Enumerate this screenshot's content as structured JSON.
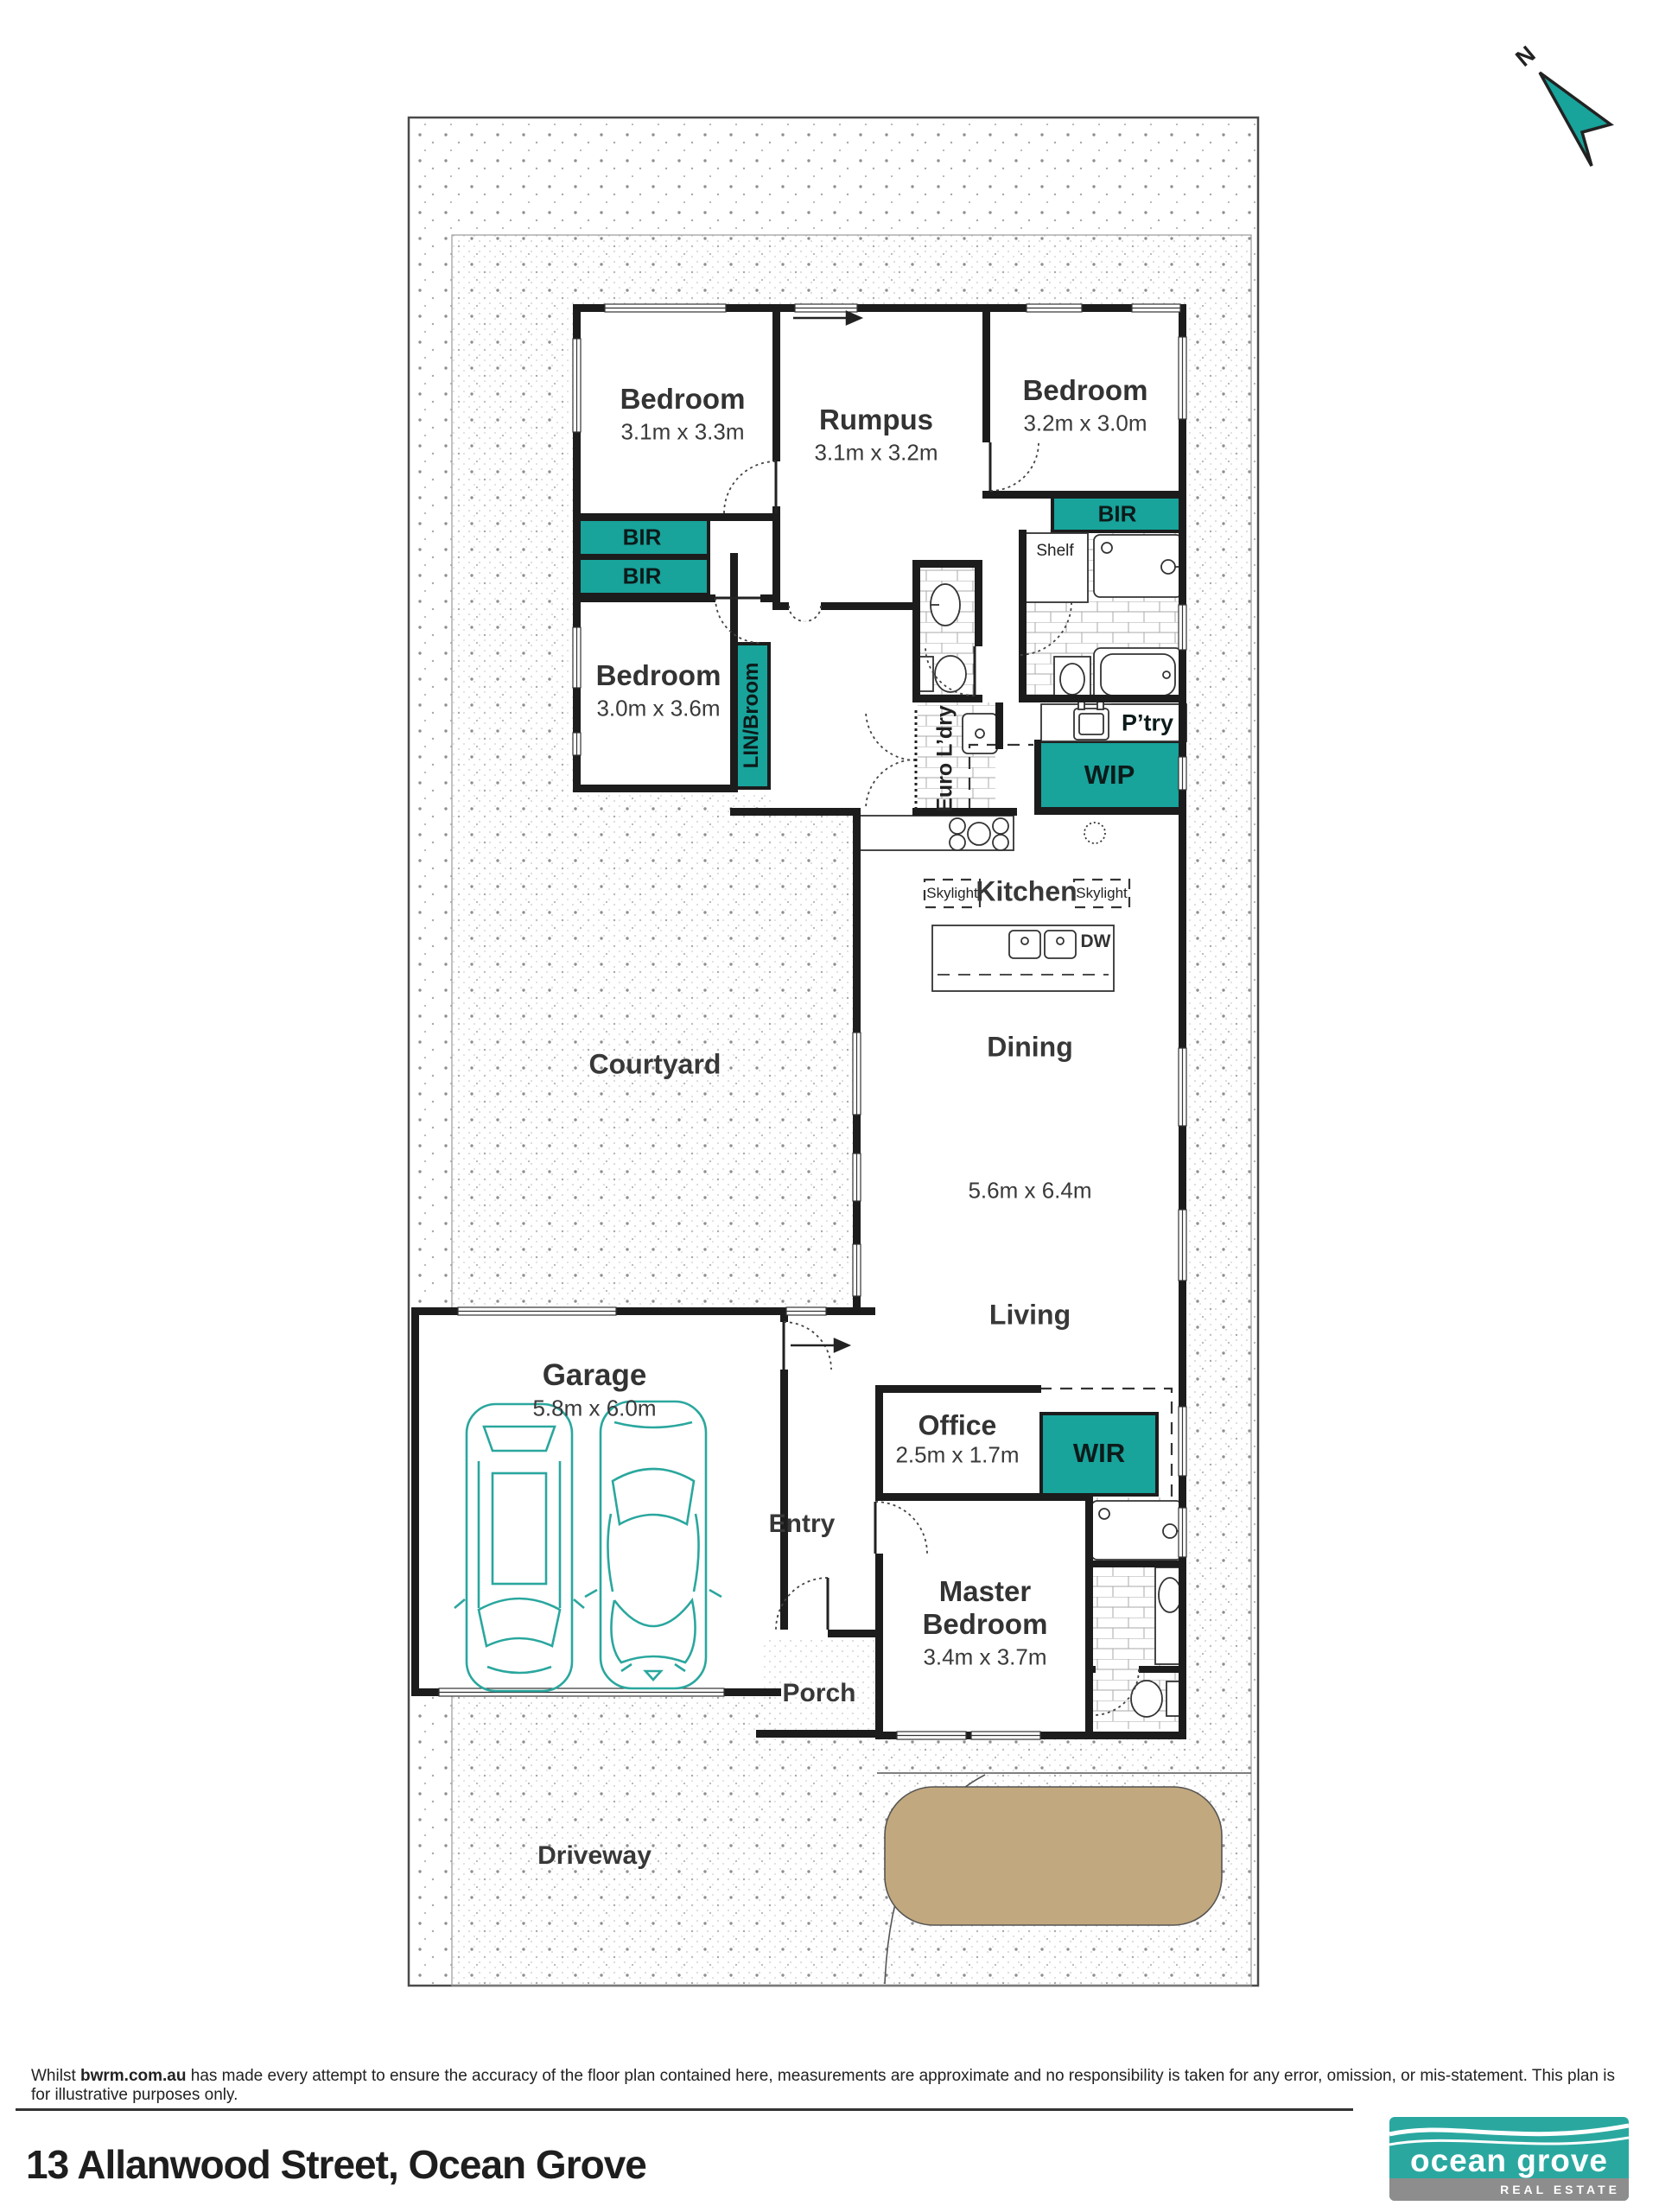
{
  "compass": {
    "north_label": "N"
  },
  "rooms": {
    "bedroom1": {
      "label": "Bedroom",
      "dims": "3.1m x 3.3m"
    },
    "rumpus": {
      "label": "Rumpus",
      "dims": "3.1m x 3.2m"
    },
    "bedroom2": {
      "label": "Bedroom",
      "dims": "3.2m x 3.0m"
    },
    "bedroom3": {
      "label": "Bedroom",
      "dims": "3.0m x 3.6m"
    },
    "courtyard": {
      "label": "Courtyard"
    },
    "dining": {
      "label": "Dining"
    },
    "living": {
      "label": "Living"
    },
    "open_plan_dims": "5.6m x 6.4m",
    "kitchen": {
      "label": "Kitchen"
    },
    "garage": {
      "label": "Garage",
      "dims": "5.8m x 6.0m"
    },
    "office": {
      "label": "Office",
      "dims": "2.5m x 1.7m"
    },
    "master": {
      "label_line1": "Master",
      "label_line2": "Bedroom",
      "dims": "3.4m x 3.7m"
    },
    "entry": {
      "label": "Entry"
    },
    "porch": {
      "label": "Porch"
    },
    "driveway": {
      "label": "Driveway"
    }
  },
  "closets": {
    "bir1": "BIR",
    "bir2": "BIR",
    "bir3": "BIR",
    "lin_broom": "LIN/Broom",
    "euro_ldry": "Euro L’dry",
    "ptry": "P’try",
    "wip": "WIP",
    "wir": "WIR",
    "shelf": "Shelf"
  },
  "annotations": {
    "skylight1": "Skylight",
    "skylight2": "Skylight",
    "dw": "DW"
  },
  "footer": {
    "disclaimer_prefix": "Whilst ",
    "disclaimer_bold": "bwrm.com.au",
    "disclaimer_rest": " has made every attempt to ensure the accuracy of the floor plan contained here, measurements are approximate and no responsibility is taken for any error, omission, or mis-statement. This plan is for illustrative purposes only.",
    "address": "13 Allanwood Street, Ocean Grove"
  },
  "logo": {
    "name_line": "ocean grove",
    "tagline": "REAL ESTATE"
  },
  "colors": {
    "teal": "#18a39b",
    "logo_teal": "#2aa8a0",
    "tan": "#c2a87e",
    "wall": "#1c1c1c"
  }
}
